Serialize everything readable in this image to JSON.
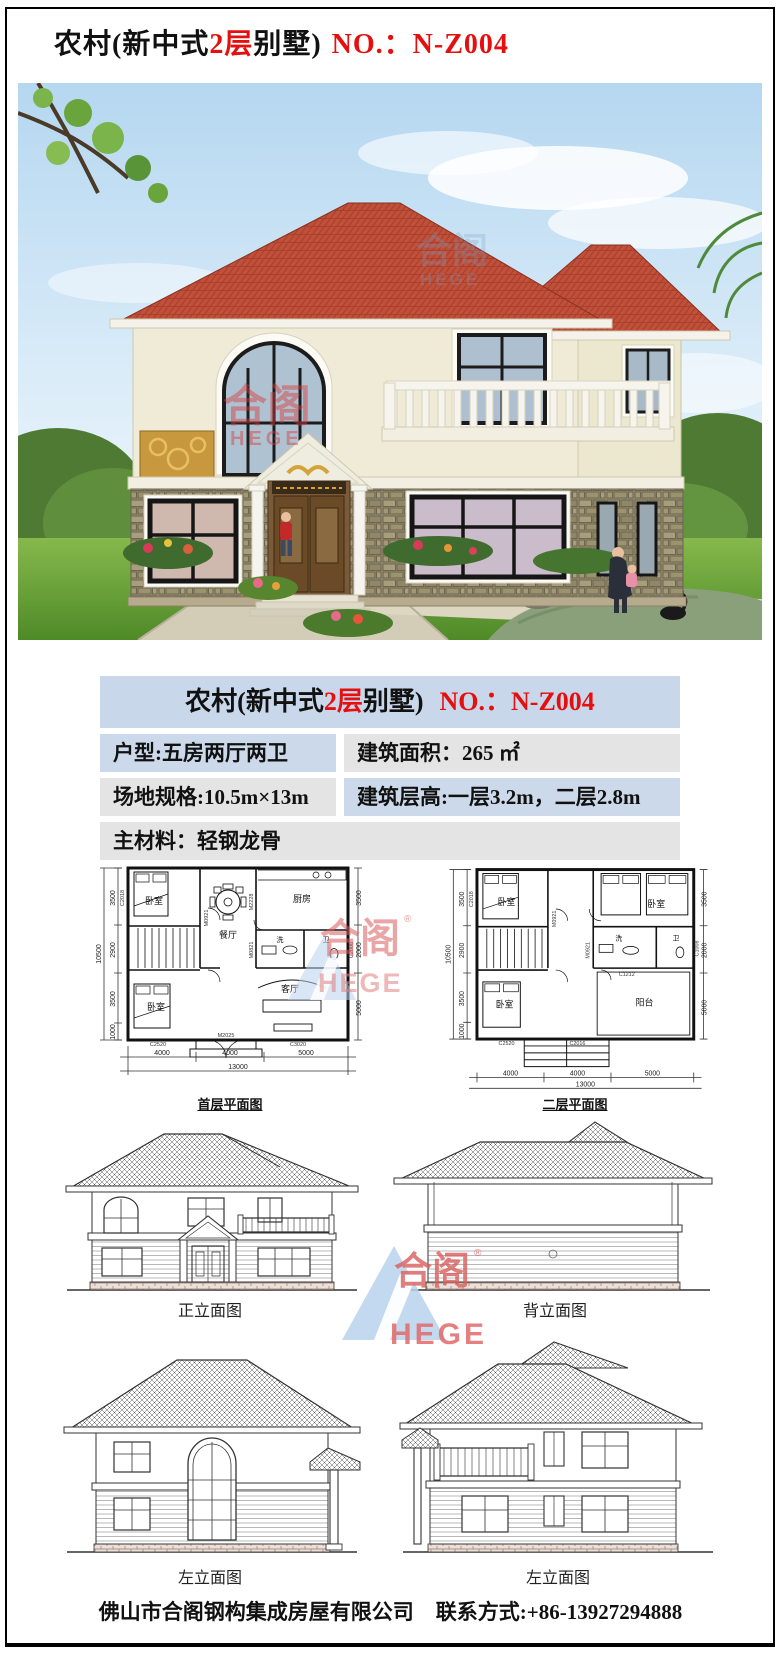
{
  "title": {
    "black1": "农村(新中式",
    "floors_red": "2层",
    "black2": "别墅)",
    "no_red": "NO.：N-Z004"
  },
  "colors": {
    "accent_red": "#e60f0f",
    "table_blue": "#ccd9ea",
    "table_gray": "#e4e4e4",
    "roof_tile": "#c0503a",
    "logo_blue": "#b9d2ec",
    "logo_red": "#d95f5f"
  },
  "specs": {
    "header_black1": "农村(新中式",
    "header_floors_red": "2层",
    "header_black2": "别墅)",
    "header_no_red": "NO.：N-Z004",
    "unit_type": "户型:五房两厅两卫",
    "area": "建筑面积：265 ㎡",
    "site": "场地规格:10.5m×13m",
    "storey_height": "建筑层高:一层3.2m，二层2.8m",
    "material": "主材料：轻钢龙骨"
  },
  "logo": {
    "cn": "合阁",
    "en": "HEGE",
    "reg": "®"
  },
  "plans": {
    "first": {
      "label": "首层平面图",
      "rooms": [
        "卧室",
        "餐厅",
        "厨房",
        "洗",
        "卫",
        "客厅",
        "卧室"
      ],
      "codes": [
        "C2018",
        "M0921",
        "M2228",
        "M0821",
        "C2006",
        "C3020",
        "C2520",
        "M2025"
      ],
      "dims_bottom": [
        "4000",
        "4000",
        "5000"
      ],
      "bottom_total": "13000",
      "dims_left": [
        "3500",
        "2900",
        "3500",
        "1000"
      ],
      "left_total": "10500",
      "dims_right": [
        "3500",
        "2000",
        "5000"
      ]
    },
    "second": {
      "label": "二层平面图",
      "rooms": [
        "卧室",
        "卧室",
        "洗",
        "卫",
        "卧室",
        "阳台"
      ],
      "codes": [
        "C2018",
        "M0921",
        "M0921",
        "C1008",
        "C1212",
        "C2520",
        "C2016"
      ],
      "dims_bottom": [
        "4000",
        "4000",
        "5000"
      ],
      "bottom_total": "13000",
      "dims_left": [
        "3500",
        "2900",
        "3500",
        "1000"
      ],
      "left_total": "10500",
      "dims_right": [
        "3500",
        "2000",
        "5000"
      ]
    }
  },
  "elevations": {
    "front_label": "正立面图",
    "back_label": "背立面图",
    "left1_label": "左立面图",
    "left2_label": "左立面图"
  },
  "footer": {
    "company": "佛山市合阁钢构集成房屋有限公司",
    "contact": "联系方式:+86-13927294888"
  }
}
